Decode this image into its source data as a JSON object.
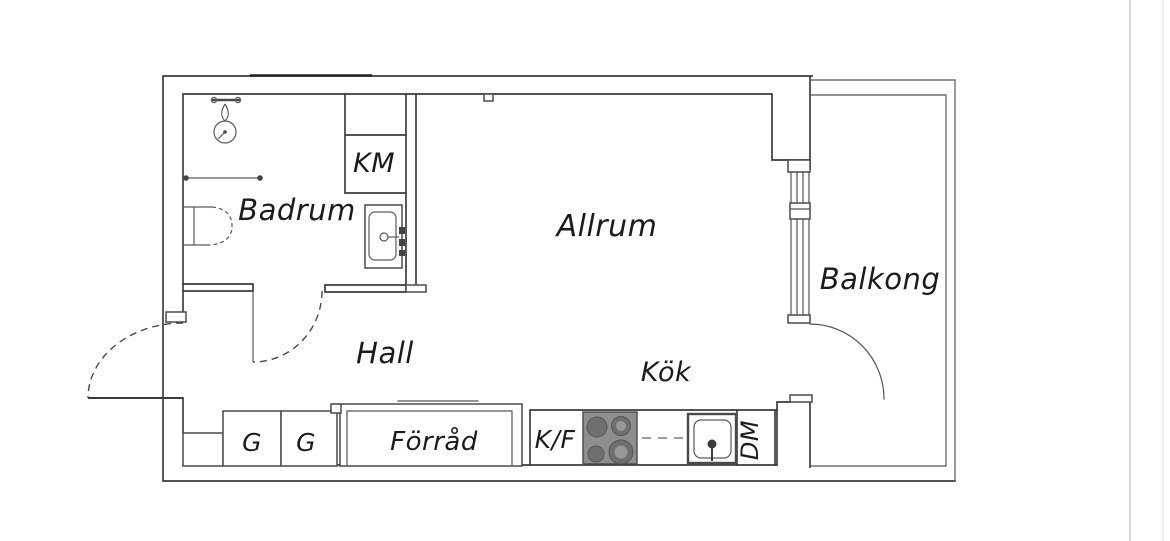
{
  "rooms": {
    "badrum": "Badrum",
    "allrum": "Allrum",
    "balkong": "Balkong",
    "hall": "Hall",
    "kok": "Kök",
    "forrad": "Förråd"
  },
  "fixtures": {
    "km": "KM",
    "g1": "G",
    "g2": "G",
    "kf": "K/F",
    "dm": "DM"
  },
  "colors": {
    "ink": "#3d3d3d",
    "label": "#1b1b1b",
    "stove_fill": "#8e8e8e",
    "burner_fill": "#6f6f6f",
    "burner_inner": "#989898",
    "artifact_line": "#c9c9c9",
    "artifact_line_light": "#e0e0e0"
  }
}
